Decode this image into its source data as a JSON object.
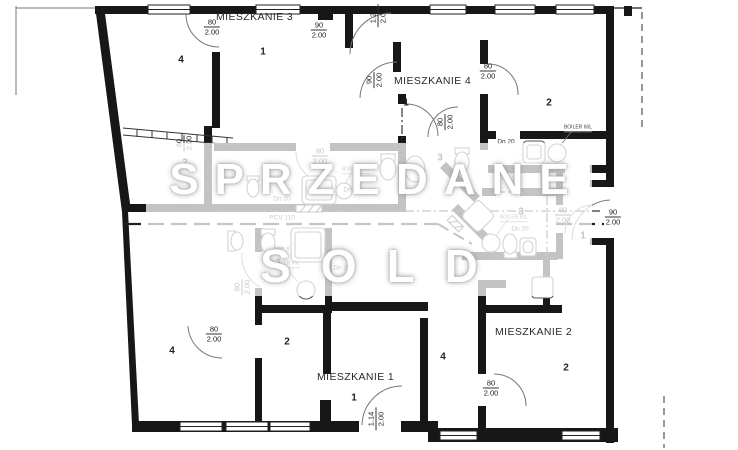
{
  "plan": {
    "apartments": {
      "m1": "MIESZKANIE 1",
      "m2": "MIESZKANIE 2",
      "m3": "MIESZKANIE 3",
      "m4": "MIESZKANIE 4"
    },
    "room_numbers": {
      "n1": "1",
      "n2": "2",
      "n3": "3",
      "n4": "4"
    },
    "dimensions": {
      "w80": "80",
      "w90": "90",
      "w114": "1.14",
      "w120": "1.20",
      "height": "2.00"
    },
    "plumbing": {
      "drain": "Dn 20",
      "pipe": "PCV 110"
    },
    "equipment": {
      "boiler": "BOILER 60L"
    },
    "watermark": {
      "line1": "SPRZEDANE",
      "line2": "SOLD"
    }
  }
}
